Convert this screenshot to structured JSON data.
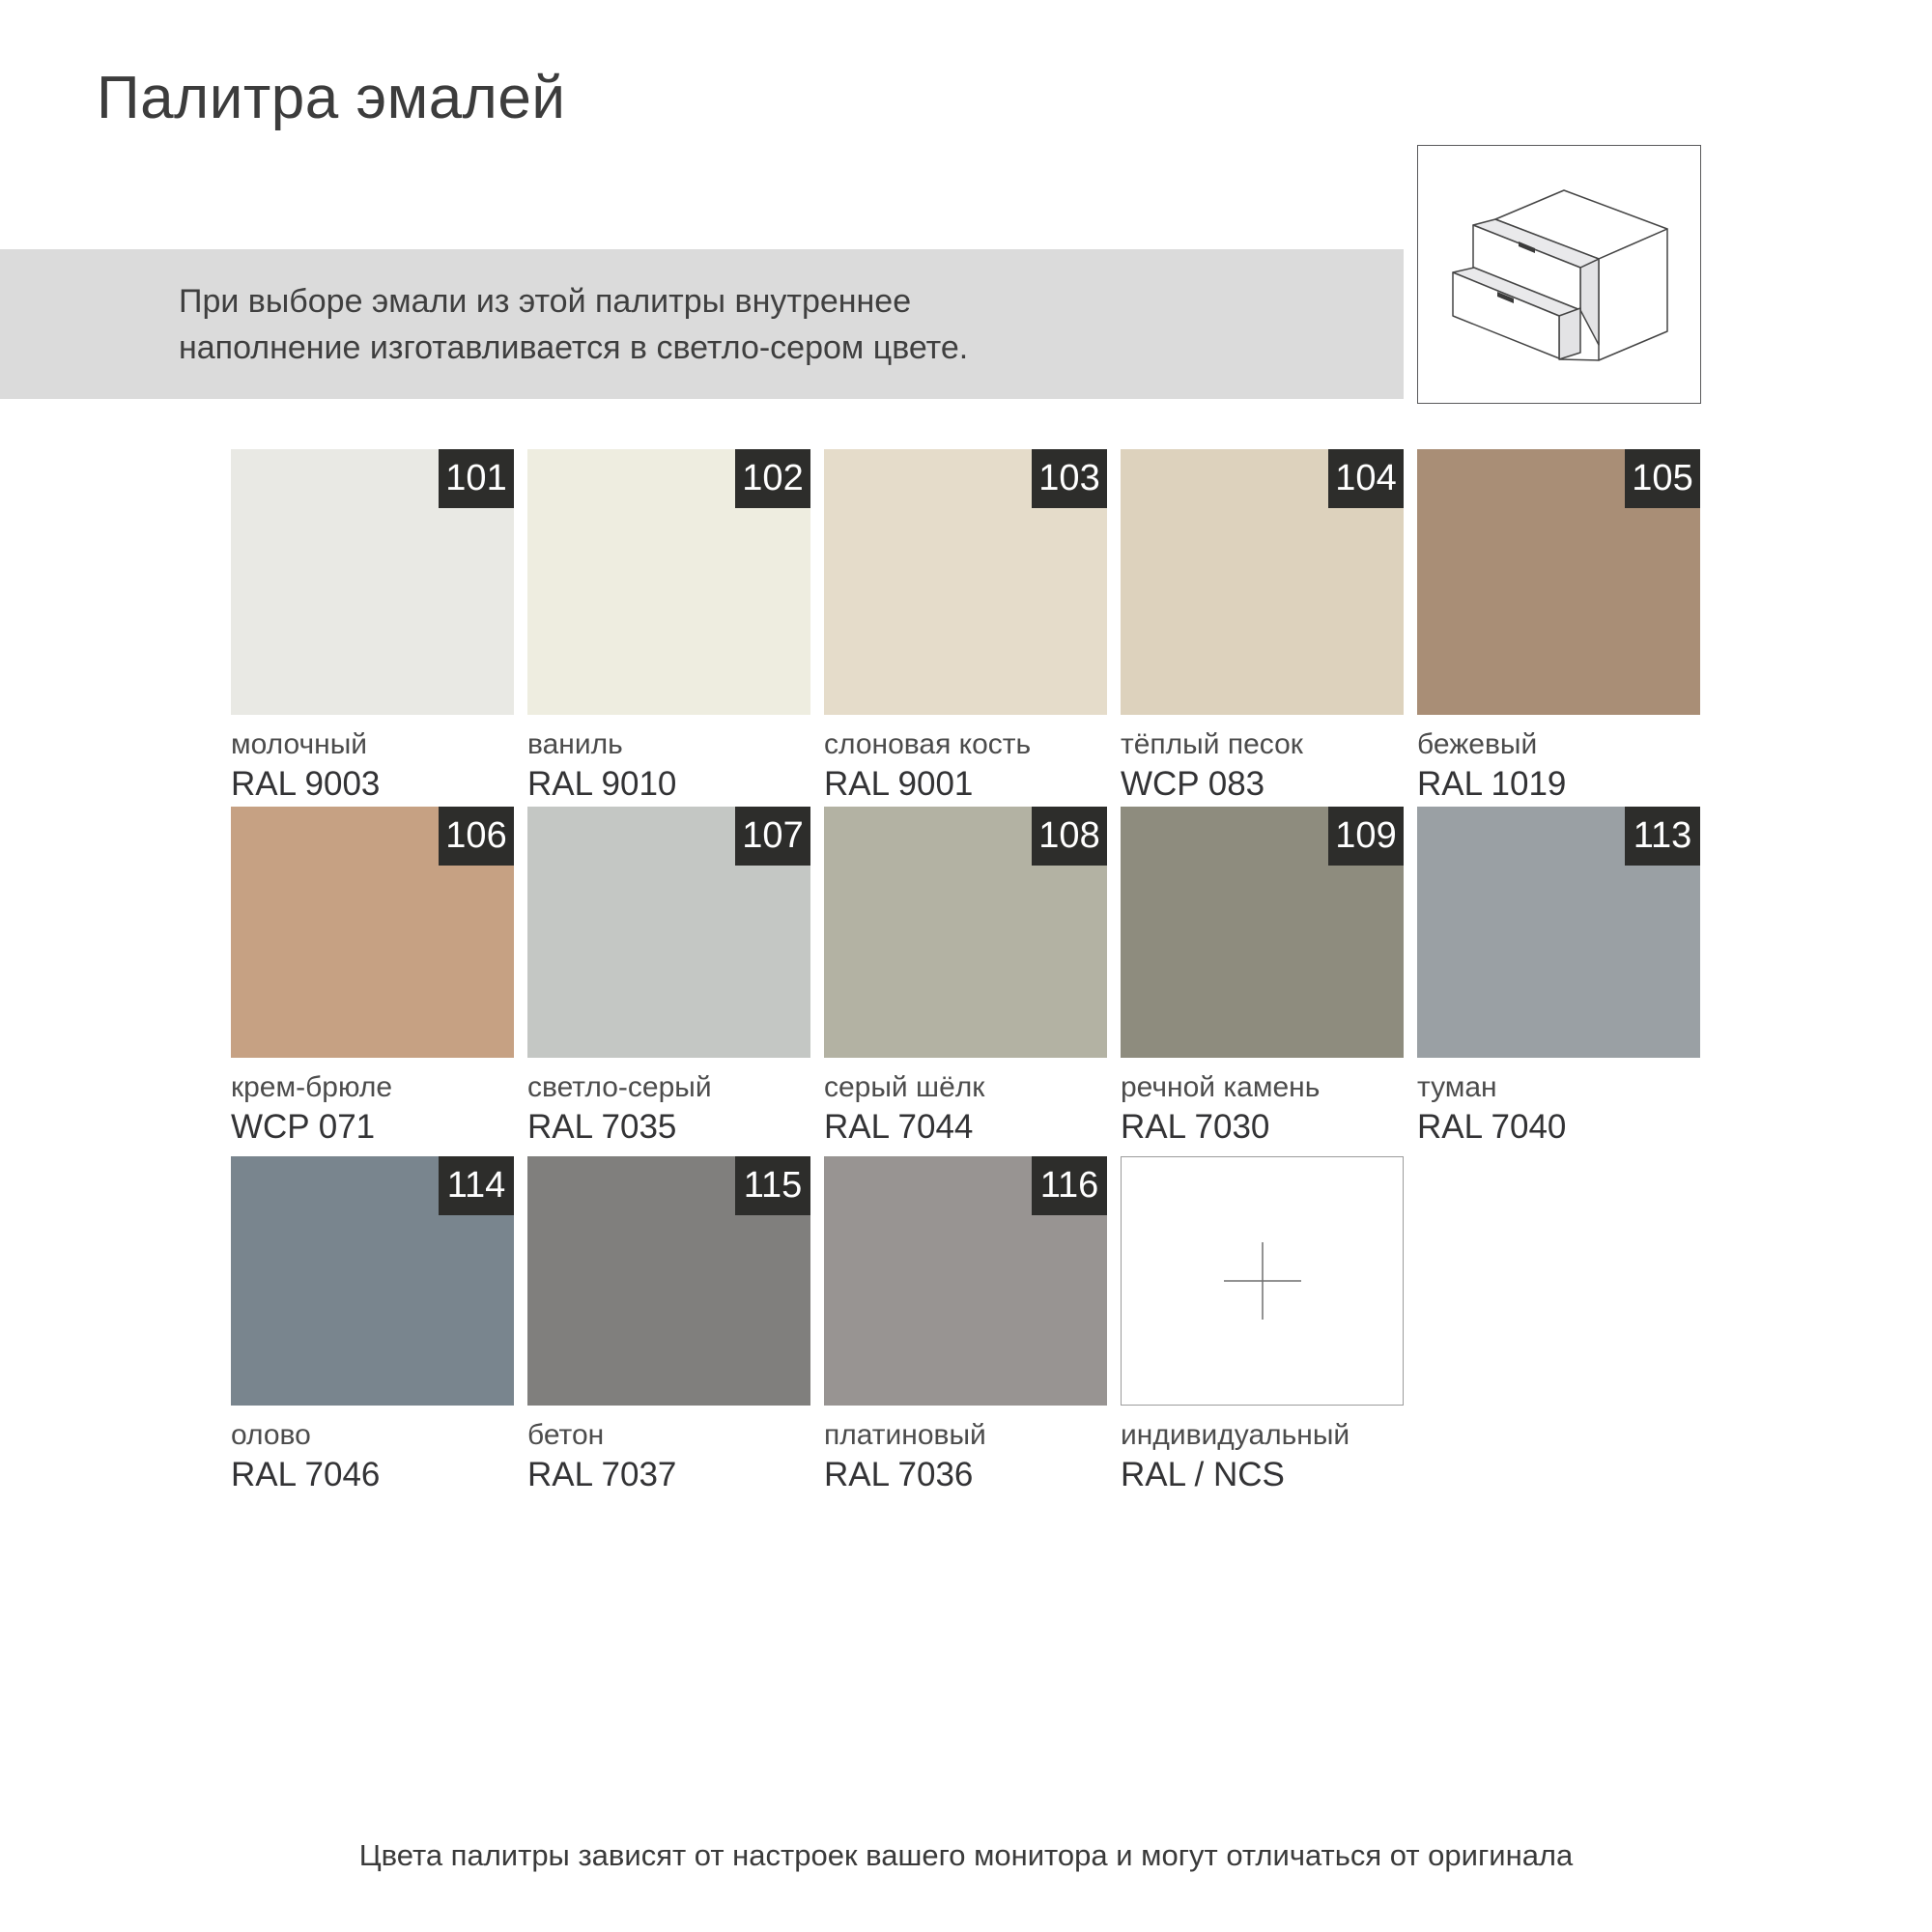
{
  "page": {
    "title": "Палитра эмалей",
    "banner": {
      "line1": "При выборе эмали из этой палитры внутреннее",
      "line2": "наполнение изготавливается в светло-сером цвете."
    },
    "footer": "Цвета палитры зависят от настроек вашего монитора и могут отличаться от оригинала"
  },
  "theme_colors": {
    "banner_bg": "#dbdbdb",
    "badge_bg": "#2d2d2b",
    "badge_text": "#ffffff",
    "title_text": "#3c3c3c",
    "label_name_text": "#4c4c4c",
    "label_code_text": "#333335",
    "custom_tile_border": "#9b9b9b"
  },
  "icons": {
    "drawer_cabinet": "drawer-cabinet-line-drawing",
    "plus": "crosshair-plus-mark"
  },
  "swatches": {
    "rows": [
      [
        {
          "num": "101",
          "name": "молочный",
          "code": "RAL 9003",
          "hex": "#e9e9e4"
        },
        {
          "num": "102",
          "name": "ваниль",
          "code": "RAL 9010",
          "hex": "#eeede0"
        },
        {
          "num": "103",
          "name": "слоновая кость",
          "code": "RAL 9001",
          "hex": "#e5dcca"
        },
        {
          "num": "104",
          "name": "тёплый песок",
          "code": "WCP 083",
          "hex": "#ddd2bd"
        },
        {
          "num": "105",
          "name": "бежевый",
          "code": "RAL 1019",
          "hex": "#a98e76"
        }
      ],
      [
        {
          "num": "106",
          "name": "крем-брюле",
          "code": "WCP 071",
          "hex": "#c6a183"
        },
        {
          "num": "107",
          "name": "светло-серый",
          "code": "RAL 7035",
          "hex": "#c4c7c4"
        },
        {
          "num": "108",
          "name": "серый шёлк",
          "code": "RAL 7044",
          "hex": "#b3b2a3"
        },
        {
          "num": "109",
          "name": "речной камень",
          "code": "RAL 7030",
          "hex": "#8e8c7e"
        },
        {
          "num": "113",
          "name": "туман",
          "code": "RAL 7040",
          "hex": "#9aa0a4"
        }
      ],
      [
        {
          "num": "114",
          "name": "олово",
          "code": "RAL 7046",
          "hex": "#79858e"
        },
        {
          "num": "115",
          "name": "бетон",
          "code": "RAL 7037",
          "hex": "#807f7d"
        },
        {
          "num": "116",
          "name": "платиновый",
          "code": "RAL 7036",
          "hex": "#989492"
        },
        {
          "num": "",
          "name": "индивидуальный",
          "code": "RAL / NCS",
          "hex": "#ffffff"
        }
      ]
    ]
  }
}
